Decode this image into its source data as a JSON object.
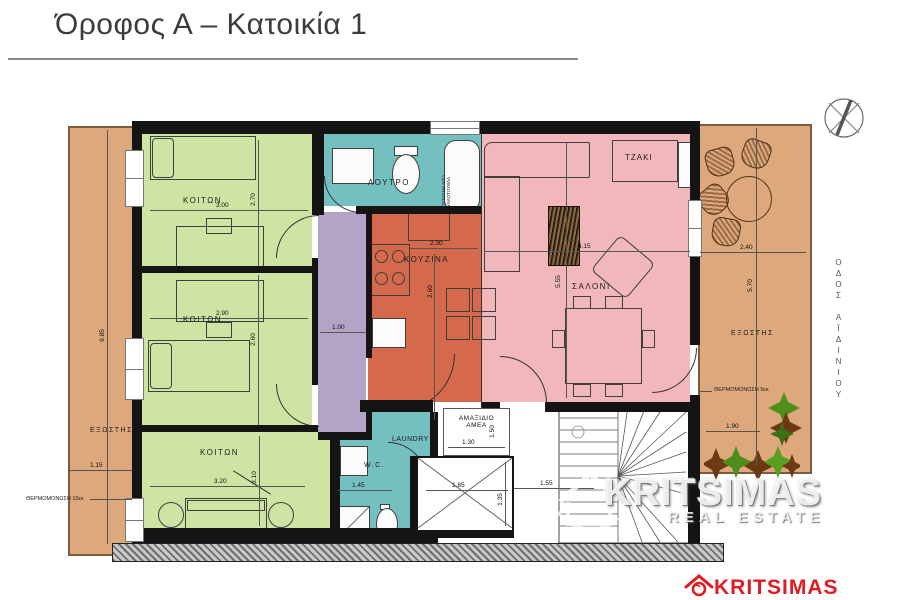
{
  "slide": {
    "title": "Όροφος Α – Κατοικία 1"
  },
  "rooms": {
    "bedroom1": {
      "label": "ΚΟΙΤΩΝ"
    },
    "bedroom2": {
      "label": "ΚΟΙΤΩΝ"
    },
    "bedroom3": {
      "label": "ΚΟΙΤΩΝ"
    },
    "bathroom": {
      "label": "ΛΟΥΤΡΟ"
    },
    "kitchen": {
      "label": "ΚΟΥΖΙΝΑ"
    },
    "living": {
      "label": "ΣΑΛΟΝΙ"
    },
    "fireplace": {
      "label": "ΤΖΑΚΙ"
    },
    "balcony_left": {
      "label": "ΕΞΩΣΤΗΣ"
    },
    "balcony_right": {
      "label": "ΕΞΩΣΤΗΣ"
    },
    "laundry": {
      "label": "LAUNDRY"
    },
    "wc": {
      "label": "W.C."
    },
    "amea": {
      "line1": "ΑΜΑΞΙΔΙΟ",
      "line2": "ΑΜΕΑ"
    }
  },
  "notes": {
    "glassblock_line1": "ΠΕΤΑΣΜΑ ΑΠΟ",
    "glassblock_line2": "ΥΑΛΟΤΟΥΒΛΑ",
    "insulation_left": "ΘΕΡΜΟΜΟΝΩΣΗ 10εκ",
    "insulation_right": "ΘΕΡΜΟΜΟΝΩΣΗ 5εκ",
    "street": "ΟΔΟΣ ΑΪΔΙΝΙΟΥ"
  },
  "dims": {
    "bedroom1_w": "3.00",
    "bedroom1_h": "2.70",
    "bedroom2_w": "2.90",
    "bedroom2_h": "2.60",
    "bedroom3_w": "3.20",
    "bedroom3_h": "3.10",
    "corridor_w": "1.00",
    "kitchen_w": "2.30",
    "kitchen_h": "2.60",
    "living_w": "4.15",
    "living_h": "5.55",
    "balcony_right_w": "2.40",
    "balcony_right_h": "5.70",
    "balcony_left_w": "1.15",
    "balcony_left_h": "9.85",
    "wc_w": "1.45",
    "amea_w": "1.30",
    "amea_h": "1.50",
    "elevator_w": "1.85",
    "elevator_h": "1.35",
    "stair_w": "1.55",
    "planter_w": "1.90"
  },
  "watermark": {
    "line1": "KRITSIMAS",
    "line2": "REAL ESTATE"
  },
  "logo": {
    "text": "KRITSIMAS"
  },
  "colors": {
    "bedroom_green": "#cfe3a2",
    "bath_teal": "#74c0c1",
    "kitchen_terracotta": "#d5694b",
    "living_pink": "#f1b7ba",
    "hall_purple": "#b3a4c7",
    "balcony_tan": "#dda97c",
    "wall_black": "#141414",
    "logo_red": "#e11b22"
  }
}
